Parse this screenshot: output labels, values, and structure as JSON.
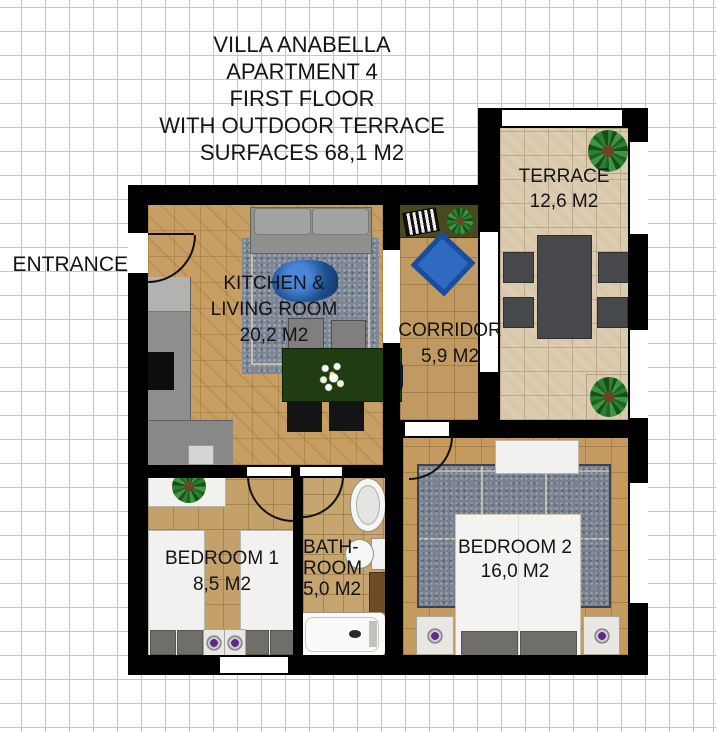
{
  "title": {
    "lines": [
      "VILLA ANABELLA",
      "APARTMENT 4",
      "FIRST FLOOR",
      "WITH OUTDOOR TERRACE",
      "SURFACES 68,1 M2"
    ]
  },
  "entrance_label": "ENTRANCE",
  "rooms": {
    "kitchen_living": {
      "lines": [
        "KITCHEN &",
        "LIVING ROOM",
        "20,2 M2"
      ],
      "name": "Kitchen & Living Room",
      "area_m2": "20,2"
    },
    "corridor": {
      "lines": [
        "CORRIDOR",
        "5,9 M2"
      ],
      "name": "Corridor",
      "area_m2": "5,9"
    },
    "terrace": {
      "lines": [
        "TERRACE",
        "12,6 M2"
      ],
      "name": "Terrace",
      "area_m2": "12,6"
    },
    "bedroom1": {
      "lines": [
        "BEDROOM 1",
        "8,5 M2"
      ],
      "name": "Bedroom 1",
      "area_m2": "8,5"
    },
    "bathroom": {
      "lines": [
        "BATH-",
        "ROOM",
        "5,0 M2"
      ],
      "name": "Bathroom",
      "area_m2": "5,0"
    },
    "bedroom2": {
      "lines": [
        "BEDROOM 2",
        "16,0 M2"
      ],
      "name": "Bedroom 2",
      "area_m2": "16,0"
    }
  },
  "colors": {
    "wall": "#000000",
    "wood_floor": "#c79e63",
    "tile_floor": "#c4a06a",
    "terrace_floor": "#d9c8ac",
    "living_rug": "#7d8694",
    "bedroom_rug": "#78818f",
    "corridor_rug": "#2e6ac0",
    "dining_table_green": "#203c12",
    "coffee_table_blue": "#2a5ca8",
    "outdoor_furniture_gray": "#47484b",
    "grid_line": "#c6c6c6"
  }
}
